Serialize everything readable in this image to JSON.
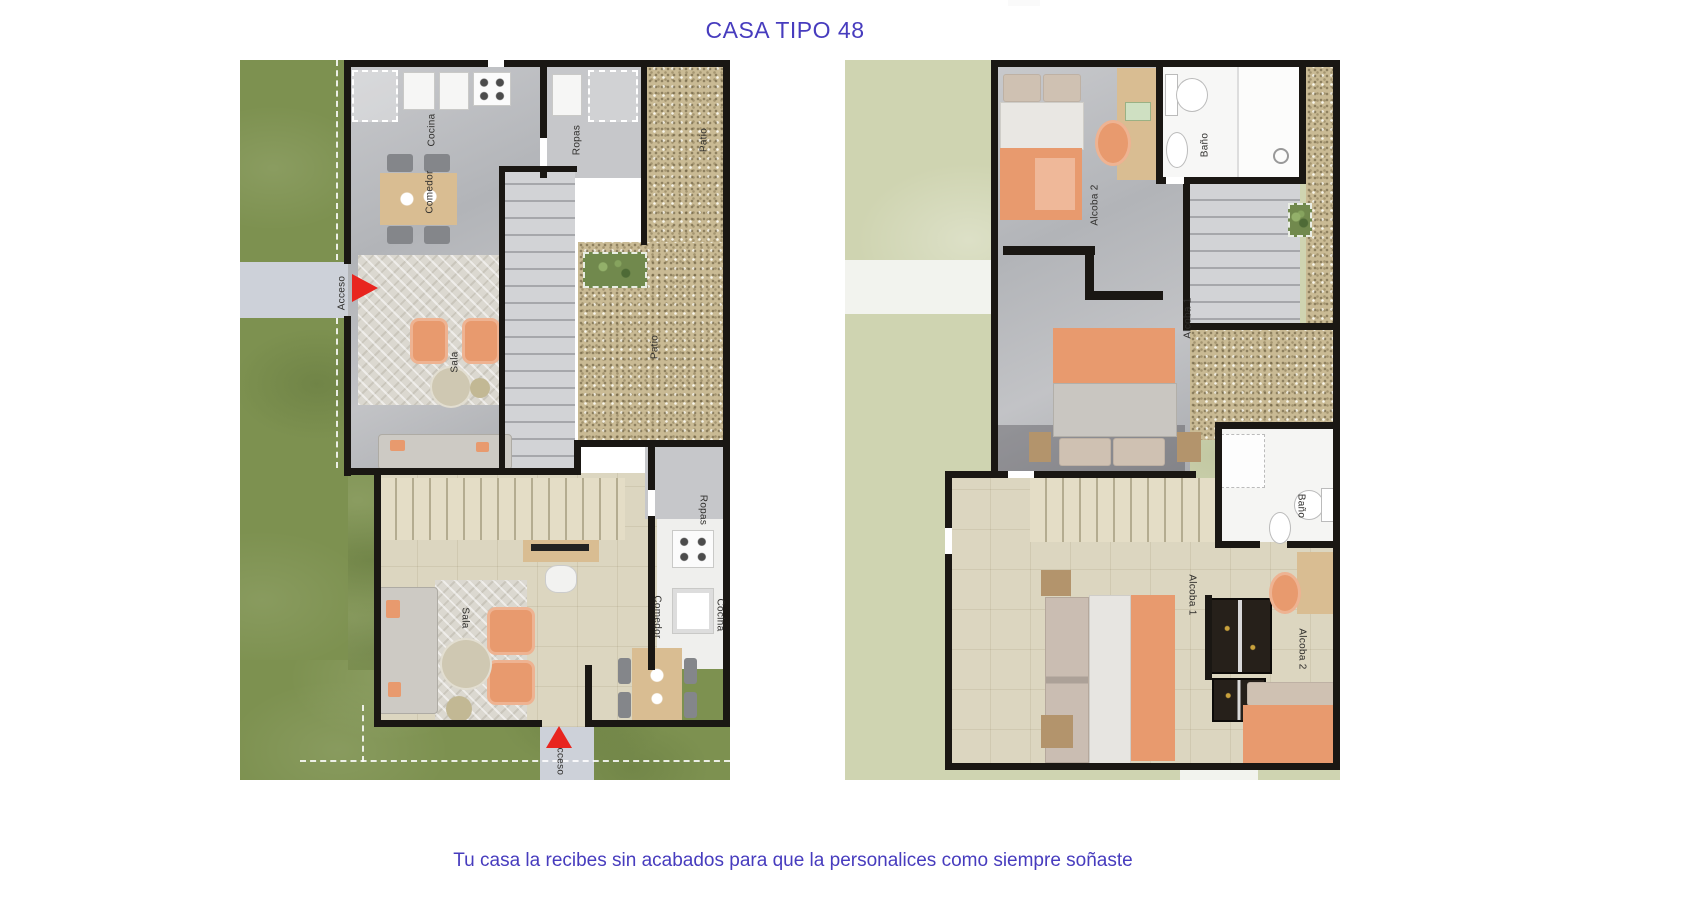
{
  "title": "CASA TIPO 48",
  "caption": "Tu casa la recibes sin acabados para que la personalices como siempre soñaste",
  "theme": {
    "accent_color": "#473cbe",
    "arrow_color": "#e8251f",
    "wall_color": "#1a1713",
    "lawn_dark": "#7d9150",
    "lawn_pale": "#cfd4b1",
    "gravel": "#c9ba94",
    "floor_beige": "#dcd6c0",
    "furniture_orange": "#e89a6e"
  },
  "plan1_labels": {
    "cocina_top": "Cocina",
    "comedor_top": "Comedor",
    "ropas_top": "Ropas",
    "patio_top": "Patio",
    "patio_mid": "Patio",
    "sala_top": "Sala",
    "acceso_left": "Acceso",
    "sala_bottom": "Sala",
    "comedor_bottom": "Comedor",
    "cocina_bottom": "Cocina",
    "ropas_bottom": "Ropas",
    "acceso_bottom": "Acceso"
  },
  "plan2_labels": {
    "alcoba2_top": "Alcoba 2",
    "bano_top": "Baño",
    "alcoba1_top": "Alcoba 1",
    "alcoba1_bottom": "Alcoba 1",
    "bano_bottom": "Baño",
    "alcoba2_bottom": "Alcoba 2"
  }
}
